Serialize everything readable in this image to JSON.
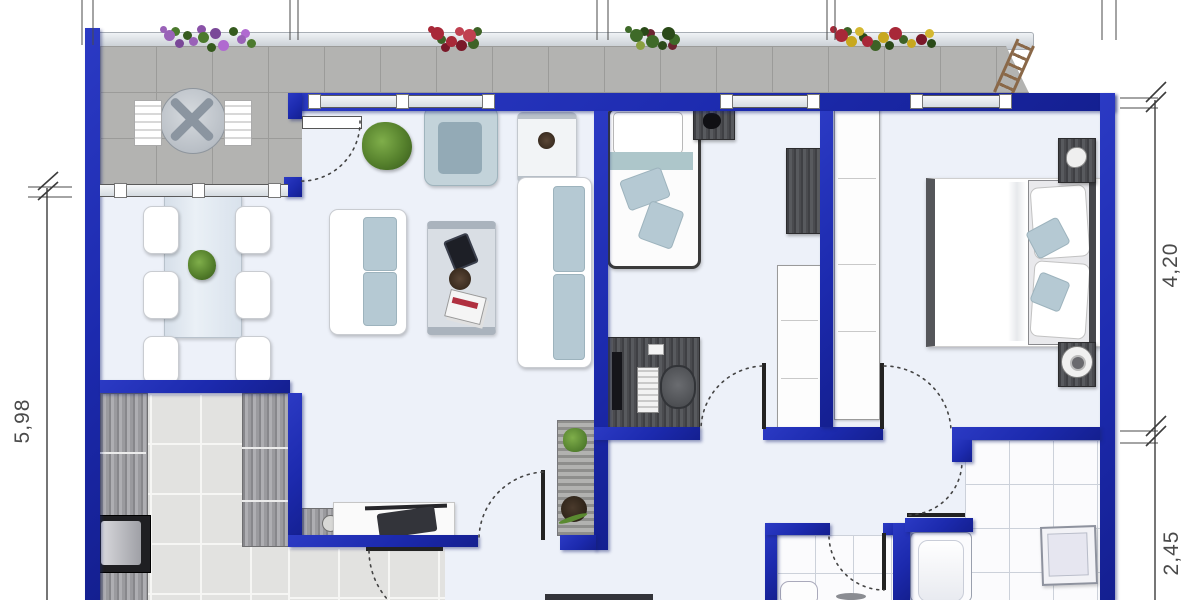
{
  "plan": {
    "dimensions": {
      "left": "5,98",
      "right_top": "4,20",
      "right_bottom": "2,45"
    },
    "colors": {
      "wall": "#1c2aae",
      "floor": "#edf1f9",
      "terrace": "#b3b3b1",
      "terrace_line": "#9b9b99",
      "kitchen_tile": "#e2e2e0",
      "kitchen_grout": "#f6f6f4",
      "bath_tile": "#fbfbfd",
      "bath_grout": "#ccd1da",
      "cushion": "#b5c9d3",
      "outline": "#c9ccd1",
      "plant": "#55802c",
      "plant_dark": "#35571a",
      "dim": "#4a4a4a",
      "leaf": "#222222"
    }
  }
}
